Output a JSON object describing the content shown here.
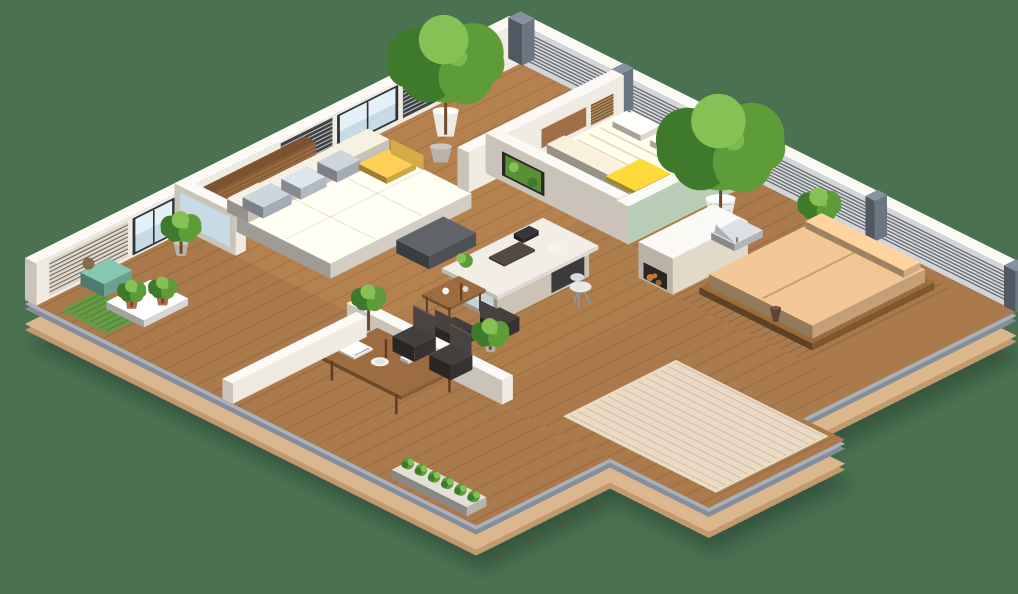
{
  "meta": {
    "description": "3D isometric cutaway floor plan render of a one-bedroom apartment with wrap-around wooden terraces, railings and potted plants on a plain green background"
  },
  "scene": {
    "rooms": [
      {
        "name": "living-room",
        "objects": [
          "wood-slat-accent-wall",
          "wall-shelves",
          "cream-daybed-sofa",
          "gray-pillows",
          "yellow-pillows",
          "dark-gray-ottoman",
          "sky-window"
        ]
      },
      {
        "name": "kitchen",
        "objects": [
          "white-kitchen-island",
          "glass-display-base",
          "white-stool",
          "serving-tray",
          "breakfast-table",
          "two-dark-chairs"
        ]
      },
      {
        "name": "bedroom",
        "objects": [
          "platform-bed",
          "cream-mattress",
          "yellow-throw-blanket",
          "wood-headboard-panel",
          "slatted-wall-panel",
          "glowing-wall-sconce",
          "sage-green-accent-wall"
        ]
      },
      {
        "name": "left-balcony",
        "objects": [
          "louvered-screen",
          "glass-door",
          "teal-pouf",
          "grass-mat",
          "white-plant-tray",
          "terracotta-pots"
        ]
      },
      {
        "name": "dining-terrace",
        "objects": [
          "wood-dining-table",
          "two-dark-chairs",
          "white-plates",
          "red-roses",
          "books",
          "white-half-wall",
          "railing-planter"
        ]
      },
      {
        "name": "daybed-terrace",
        "objects": [
          "tan-outdoor-daybed",
          "slatted-deck",
          "gray-lounge-chair",
          "dark-vase",
          "large-potted-trees",
          "gray-concrete-walls",
          "wall-niche-plant"
        ]
      },
      {
        "name": "patio",
        "objects": [
          "striped-beige-rug",
          "wood-armchair",
          "gray-cushions",
          "teal-upholstered-bench",
          "white-towel",
          "wire-railing",
          "grass-tufts"
        ]
      }
    ],
    "exterior": [
      "tan-platform-base",
      "steel-rim",
      "mesh-railings",
      "gray-posts",
      "louvered-privacy-screens",
      "white-wall-caps"
    ]
  },
  "colors": {
    "bg": "#4a7150",
    "shadow": "#1e3323",
    "baseTan": "#dab78d",
    "baseTanDark": "#c19a6f",
    "rimGray": "#a9b2bb",
    "rimGrayDark": "#848e99",
    "woodFloor": "#b5824f",
    "woodDeck": "#aa7a4c",
    "plankLine": "#50300f",
    "slatLine": "#5e3a16",
    "rug": "#e9dbc5",
    "rugStripe": "#c3a079",
    "wallWhite": "#efeae2",
    "wallCap": "#fbfaf7",
    "wallShadeL": "#c9c3b9",
    "wallShadeR": "#e0dad1",
    "woodWall": "#9b6a41",
    "woodWallDark": "#7c5230",
    "louverLightBg": "#ded8cd",
    "louverLightLine": "#6b6257",
    "louverDarkBg": "#3f4245",
    "louverDarkLine": "#b9bcbe",
    "neLouverBg": "#d3d5d6",
    "neLouverLine": "#585d62",
    "frameDark": "#2f3335",
    "windowGlass": "#c7dbe7",
    "windowSky": "#eaf4fa",
    "greenWall": "#b9cdb7",
    "sofa": "#e9e5da",
    "sofaBack": "#dcd7ca",
    "pillowGray": "#b7bec7",
    "pillowBlue": "#c6cdd4",
    "pillowYellow": "#e5ba4d",
    "ottoman": "#56595d",
    "islandBase": "#e3d9c9",
    "islandTop": "#f2eee6",
    "glassDisplay": "#ccd8da",
    "appliance": "#3b3b3d",
    "stool": "#e8e8e6",
    "tableTop": "#9d6c40",
    "tableLeg": "#5f3d20",
    "chairDark": "#3c3836",
    "bedBase": "#b4ac9e",
    "bedCream": "#ece4d3",
    "bedWedge": "#e0d6c2",
    "bedYellow": "#ecc335",
    "headboard": "#a06f45",
    "slatPanel": "#b08756",
    "sconce": "#f7c93e",
    "daybed": "#d9b185",
    "daybedBase": "#8a6136",
    "lounge": "#c6c9cb",
    "benchTeal": "#55a18c",
    "benchBase": "#8f8576",
    "pillowTan": "#c8b79b",
    "cloth": "#f2f1ec",
    "pouf": "#76b3a0",
    "grass": "#679a44",
    "tray": "#f0eee9",
    "potTerracotta": "#b06f48",
    "potWhite": "#eceae4",
    "potGray": "#b8b3aa",
    "plantDark": "#3f7a2c",
    "plantMid": "#5e9c3a",
    "plantLight": "#85c155",
    "trunk": "#6e4a28",
    "grayWall": "#9aa3ac",
    "postGray": "#788290",
    "meshPanel": "#dde0e3",
    "meshLine": "#8e969e",
    "railSteel": "#eef1f3",
    "wireLine": "#b6bcc2",
    "plate": "#f5f4f0",
    "rose": "#c4273c",
    "roseGreen": "#3e6b2a",
    "book": "#f4f2ec",
    "vase": "#5c4434",
    "log": "#c97b3a",
    "nicheDark": "#2b2622"
  }
}
